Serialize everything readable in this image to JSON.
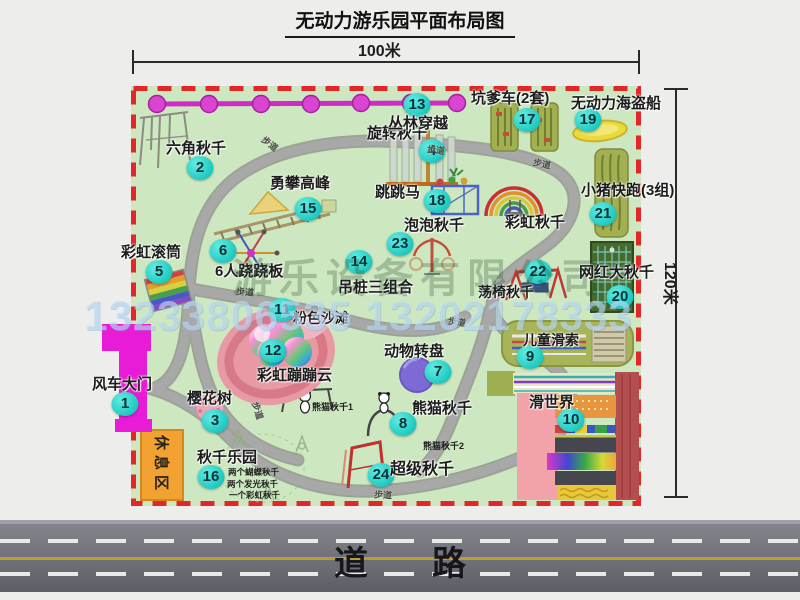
{
  "title": "无动力游乐园平面布局图",
  "dimensions": {
    "width": "100米",
    "height": "120米"
  },
  "road_label": "道路",
  "rest_area_label": "休息区",
  "watermarks": {
    "company": "游乐设备有限公司",
    "phone": "13233806535 13202178333"
  },
  "colors": {
    "map_bg": "#cde7c0",
    "boundary_red": "#e02828",
    "badge_teal": "#1fc9c0",
    "path_gray": "#9b9b9b",
    "gate_magenta": "#e81bd6",
    "rest_orange": "#f2a233",
    "bead_magenta": "#d944d0",
    "road_gray": "#6a6a72",
    "track_olive": "#a3b052"
  },
  "attractions": [
    {
      "n": 1,
      "name": "风车大门",
      "lx": 92,
      "ly": 377,
      "fs": 15,
      "bx": 125,
      "by": 404
    },
    {
      "n": 2,
      "name": "六角秋千",
      "lx": 166,
      "ly": 141,
      "fs": 15,
      "bx": 200,
      "by": 168
    },
    {
      "n": 3,
      "name": "樱花树",
      "lx": 187,
      "ly": 391,
      "fs": 15,
      "bx": 215,
      "by": 421
    },
    {
      "n": 4,
      "name": "旋转秋千",
      "lx": 367,
      "ly": 126,
      "fs": 15,
      "bx": 432,
      "by": 151
    },
    {
      "n": 5,
      "name": "彩虹滚筒",
      "lx": 121,
      "ly": 245,
      "fs": 15,
      "bx": 159,
      "by": 272
    },
    {
      "n": 6,
      "name": "6人跷跷板",
      "lx": 215,
      "ly": 264,
      "fs": 15,
      "bx": 223,
      "by": 251
    },
    {
      "n": 7,
      "name": "动物转盘",
      "lx": 384,
      "ly": 344,
      "fs": 15,
      "bx": 438,
      "by": 372
    },
    {
      "n": 8,
      "name": "熊猫秋千",
      "lx": 412,
      "ly": 401,
      "fs": 15,
      "bx": 403,
      "by": 424
    },
    {
      "n": 9,
      "name": "儿童滑索",
      "lx": 523,
      "ly": 333,
      "fs": 14,
      "bx": 530,
      "by": 357
    },
    {
      "n": 10,
      "name": "滑世界",
      "lx": 529,
      "ly": 395,
      "fs": 15,
      "bx": 571,
      "by": 420
    },
    {
      "n": 11,
      "name": "粉色沙滩",
      "lx": 293,
      "ly": 311,
      "fs": 14,
      "bx": 282,
      "by": 310
    },
    {
      "n": 12,
      "name": "彩虹蹦蹦云",
      "lx": 257,
      "ly": 368,
      "fs": 15,
      "bx": 273,
      "by": 351
    },
    {
      "n": 13,
      "name": "丛林穿越",
      "lx": 388,
      "ly": 116,
      "fs": 15,
      "bx": 417,
      "by": 105
    },
    {
      "n": 14,
      "name": "吊桩三组合",
      "lx": 338,
      "ly": 280,
      "fs": 15,
      "bx": 359,
      "by": 262
    },
    {
      "n": 15,
      "name": "勇攀高峰",
      "lx": 270,
      "ly": 176,
      "fs": 15,
      "bx": 308,
      "by": 209
    },
    {
      "n": 16,
      "name": "秋千乐园",
      "lx": 197,
      "ly": 450,
      "fs": 15,
      "bx": 211,
      "by": 477
    },
    {
      "n": 17,
      "name": "坑爹车(2套)",
      "lx": 471,
      "ly": 91,
      "fs": 15,
      "bx": 527,
      "by": 120
    },
    {
      "n": 18,
      "name": "跳跳马",
      "lx": 375,
      "ly": 185,
      "fs": 15,
      "bx": 437,
      "by": 201
    },
    {
      "n": 19,
      "name": "无动力海盗船",
      "lx": 571,
      "ly": 96,
      "fs": 15,
      "bx": 588,
      "by": 120
    },
    {
      "n": 20,
      "name": "网红大秋千",
      "lx": 579,
      "ly": 265,
      "fs": 15,
      "bx": 620,
      "by": 297
    },
    {
      "n": 21,
      "name": "小猪快跑(3组)",
      "lx": 581,
      "ly": 183,
      "fs": 15,
      "bx": 603,
      "by": 214
    },
    {
      "n": 22,
      "name": "荡椅秋千",
      "lx": 478,
      "ly": 285,
      "fs": 14,
      "bx": 538,
      "by": 272
    },
    {
      "n": 23,
      "name": "泡泡秋千",
      "lx": 404,
      "ly": 218,
      "fs": 15,
      "bx": 400,
      "by": 244
    },
    {
      "n": 24,
      "name": "超级秋千",
      "lx": 390,
      "ly": 461,
      "fs": 16,
      "bx": 381,
      "by": 475
    },
    {
      "n": null,
      "name": "彩虹秋千",
      "lx": 505,
      "ly": 215,
      "fs": 15,
      "bx": 0,
      "by": 0
    }
  ],
  "path_labels": [
    {
      "text": "步道",
      "x": 261,
      "y": 137,
      "r": 38
    },
    {
      "text": "步道",
      "x": 427,
      "y": 143,
      "r": 8
    },
    {
      "text": "步道",
      "x": 533,
      "y": 157,
      "r": 12
    },
    {
      "text": "步道",
      "x": 236,
      "y": 285,
      "r": 4
    },
    {
      "text": "步道",
      "x": 448,
      "y": 315,
      "r": 8
    },
    {
      "text": "步道",
      "x": 374,
      "y": 488,
      "r": 3
    },
    {
      "text": "步道",
      "x": 249,
      "y": 404,
      "r": 72
    }
  ],
  "notes": [
    {
      "text": "两个蝴蝶秋千",
      "x": 228,
      "y": 468,
      "fs": 8.5
    },
    {
      "text": "两个发光秋千",
      "x": 227,
      "y": 480,
      "fs": 8.5
    },
    {
      "text": "一个彩虹秋千",
      "x": 229,
      "y": 491,
      "fs": 8.5
    },
    {
      "text": "熊猫秋千1",
      "x": 312,
      "y": 403,
      "fs": 9
    },
    {
      "text": "熊猫秋千2",
      "x": 423,
      "y": 442,
      "fs": 9
    }
  ]
}
